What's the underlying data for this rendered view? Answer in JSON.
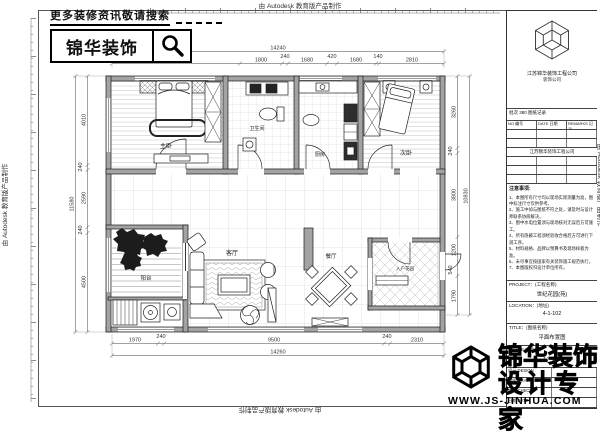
{
  "sheet": {
    "credit": "由 Autodesk 教育版产品制作"
  },
  "promo": {
    "tagline": "更多装修资讯敬请搜索",
    "brand": "锦华装饰"
  },
  "title_block": {
    "company": "江苏锦华装饰工程公司",
    "company_sub": "装饰公司",
    "rev_title": "批次 380 图纸记录",
    "rev_headers": [
      "NO 编号",
      "DATE 日期",
      "REMARKS 记录"
    ],
    "notes_title": "注意事项:",
    "notes": [
      "1、本图所有尺寸均以现场实际测量为准，图中标注尺寸仅供参考。",
      "2、施工中如与图纸不符之处，请及时与设计师联系协商解决。",
      "3、图中水电位置须与现场核对无误后方可施工。",
      "4、所有隐蔽工程须经验收合格后方可进行下道工序。",
      "5、材料规格、品牌以预算书及现场样板为准。",
      "6、未尽事宜按国家有关装饰施工规范执行。",
      "7、本图版权归设计单位所有。"
    ],
    "fields": [
      {
        "label": "PROJECT：(工程名称)",
        "value": "世纪花园(苑)"
      },
      {
        "label": "LOCATION：(地址)",
        "value": "4-1-102"
      },
      {
        "label": "TITLE：(图纸名称)",
        "value": "平面布置图"
      },
      {
        "label": "SCALE：(比例)",
        "value": "1：100"
      }
    ],
    "sig": [
      "设计 DESIGN",
      "制图 DRAWN",
      "审核 CHECK",
      "日期 DATE"
    ]
  },
  "footer": {
    "brand": "锦华装饰",
    "tagline": "设计专家",
    "url": "WWW.JS-JINHUA.COM"
  },
  "plan": {
    "rooms": [
      {
        "label": "主卧"
      },
      {
        "label": "卫生间"
      },
      {
        "label": "厨房"
      },
      {
        "label": "次卧"
      },
      {
        "label": "客厅"
      },
      {
        "label": "餐厅"
      },
      {
        "label": "阳台"
      },
      {
        "label": "入户花园"
      }
    ],
    "dims": {
      "top": {
        "total": "14240",
        "segments": [
          "5470",
          "1800",
          "240",
          "1680",
          "420",
          "1680",
          "140",
          "2810"
        ]
      },
      "bottom": {
        "total": "14260",
        "segments": [
          "1970",
          "240",
          "9500",
          "240",
          "2310"
        ]
      },
      "left": {
        "total": "11580",
        "segments": [
          "4010",
          "240",
          "2590",
          "240",
          "4500"
        ]
      },
      "right": {
        "total": "10830",
        "segments": [
          "3260",
          "240",
          "3800",
          "1200",
          "540",
          "1790"
        ]
      }
    }
  }
}
